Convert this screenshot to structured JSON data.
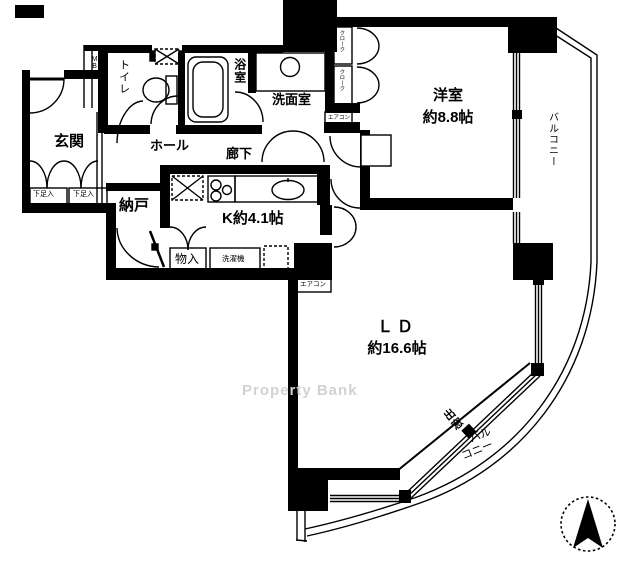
{
  "plan": {
    "rooms": {
      "genkan": "玄関",
      "toilet": "トイレ",
      "bath": "浴室",
      "washroom": "洗面室",
      "hall": "ホール",
      "corridor": "廊下",
      "nando": "納戸",
      "kitchen": "K約4.1帖",
      "mono_ire": "物入",
      "western_room_line1": "洋室",
      "western_room_line2": "約8.8帖",
      "ld_line1": "ＬＤ",
      "ld_line2": "約16.6帖"
    },
    "annotations": {
      "balcony_right_vertical": "バルコニー",
      "balcony_bottom_line1": "バル",
      "balcony_bottom_line2": "コニー",
      "bay_window": "出窓",
      "meter_box": "MB",
      "cloak_upper": "クローク",
      "cloak_lower": "クローク",
      "shoe_box_left": "下足入",
      "shoe_box_right": "下足入",
      "aircon_west_room": "エアコン",
      "aircon_ld": "エアコン",
      "washing_machine": "洗濯機"
    },
    "watermark": "Property Bank",
    "icons": {
      "compass": "north-arrow"
    },
    "colors": {
      "wall": "#000000",
      "background": "#ffffff",
      "watermark": "#d2d2d2"
    }
  }
}
